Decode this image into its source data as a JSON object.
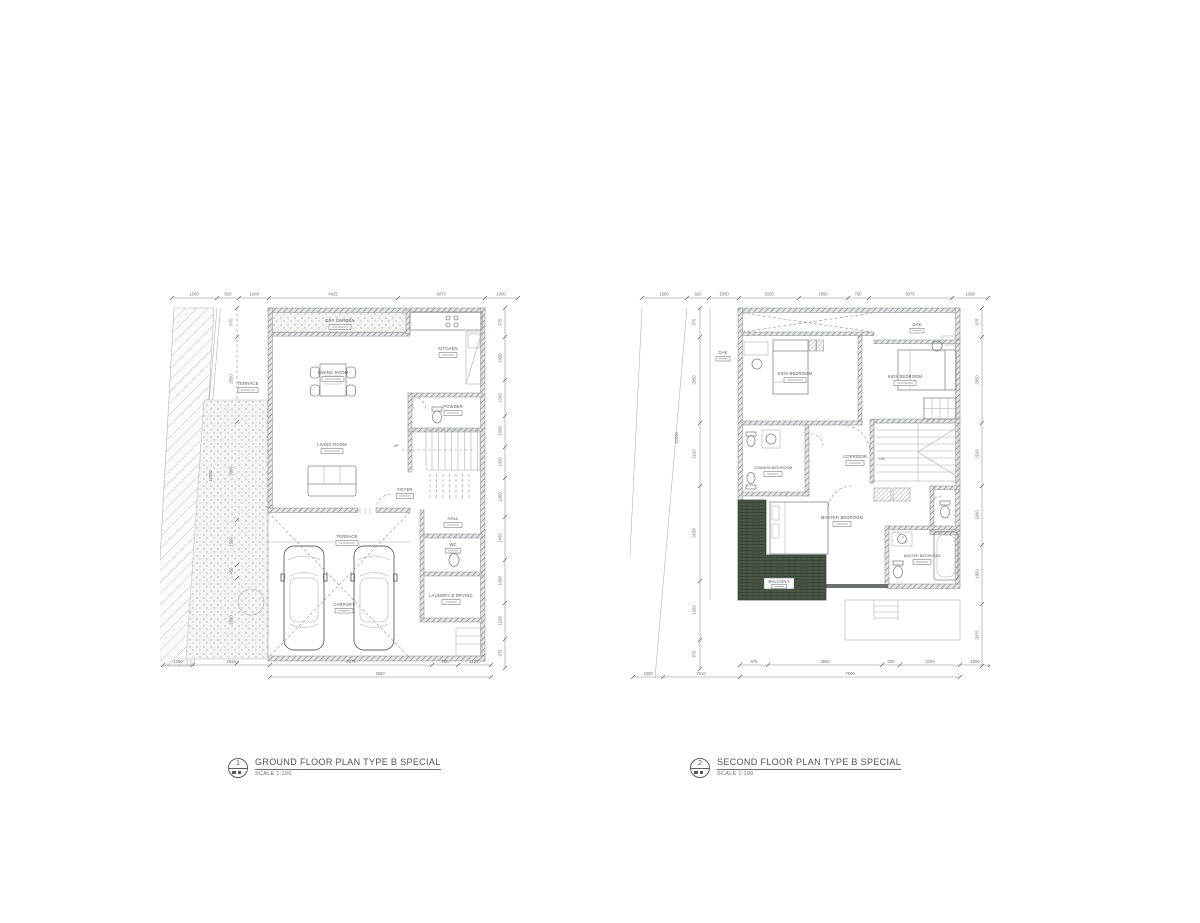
{
  "page": {
    "background": "#ffffff"
  },
  "colors": {
    "line": "#84888c",
    "line_dark": "#5f6367",
    "wall_hatch": "#7e8286",
    "text": "#54585c",
    "balcony_green": "#4a5647",
    "stipple_bg": "#f4f4f2"
  },
  "ground_plan": {
    "title": "GROUND FLOOR PLAN TYPE B SPECIAL",
    "scale": "SCALE  1:100",
    "ref_number": "1",
    "rooms": {
      "dry_garden": "DRY GARDEN",
      "kitchen": "KITCHEN",
      "dining": "DINING ROOM",
      "powder": "POWDER",
      "living": "LIVING ROOM",
      "terrace_side": "TERRACE",
      "foyer": "FOYER",
      "hall": "HALL",
      "wc": "WC",
      "laundry": "LAUNDRY & DRYING",
      "terrace_car": "TERRACE",
      "carport": "CARPORT",
      "up": "UP"
    },
    "dims_top": [
      "1500",
      "820",
      "1000",
      "4425",
      "3075",
      "1000"
    ],
    "dims_bottom": [
      "1000",
      "2810",
      "5475",
      "900",
      "1125"
    ],
    "dims_bottom_total": "7500",
    "dims_left": [
      "975",
      "2850",
      "3300",
      "1500",
      "450",
      "2850"
    ],
    "dims_left_total": "12000",
    "dims_right": [
      "975",
      "1450",
      "1200",
      "1050",
      "1050",
      "1300",
      "1450",
      "1450",
      "1200",
      "975"
    ]
  },
  "second_plan": {
    "title": "SECOND FLOOR PLAN TYPE B SPECIAL",
    "scale": "SCALE  1:100",
    "ref_number": "2",
    "rooms": {
      "dak_left": "DAK",
      "dak_right": "DAK",
      "kids_bedroom_left": "KIDS BEDROOM",
      "kids_bedroom_right": "KIDS BEDROOM",
      "common_bathroom": "COMMON BATHROOM",
      "corridor": "CORRIDOR",
      "master_bedroom": "MASTER BEDROOM",
      "master_bathroom": "MASTER BATHROOM",
      "balcony": "BALCONY",
      "dn": "DN"
    },
    "dims_top": [
      "1500",
      "820",
      "1000",
      "2025",
      "1650",
      "750",
      "3075",
      "1000"
    ],
    "dims_bottom": [
      "975",
      "3900",
      "600",
      "2025",
      "1000"
    ],
    "dims_bottom_total": "7500",
    "dims_bottom_left": [
      "1000",
      "2810"
    ],
    "dims_left": [
      "975",
      "2850",
      "2100",
      "3150",
      "1950",
      "975"
    ],
    "dims_left_total": "12000",
    "dims_right": [
      "975",
      "2850",
      "2100",
      "1950",
      "1950",
      "2075"
    ]
  }
}
